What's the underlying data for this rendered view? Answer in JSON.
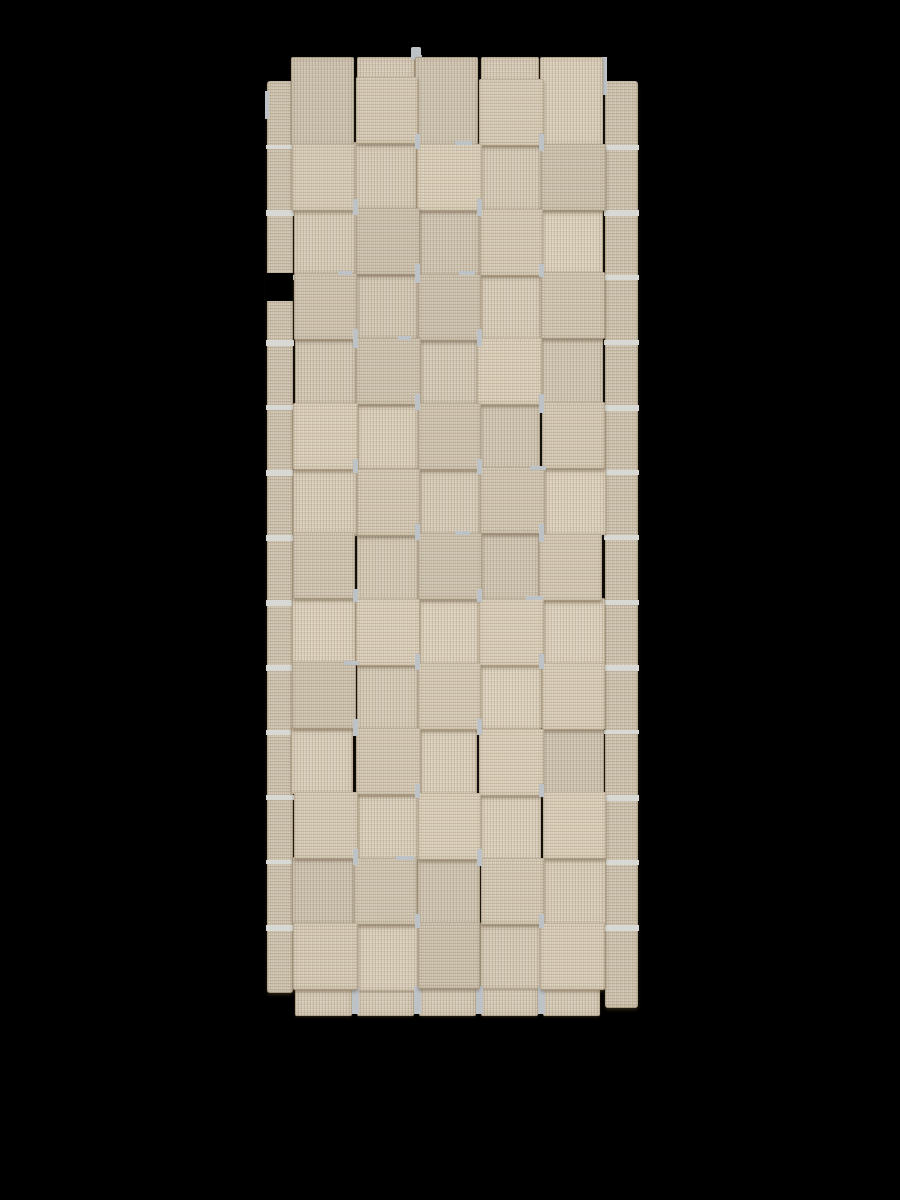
{
  "image": {
    "type": "product-photo",
    "subject": "beige basket-weave rug runner, top view",
    "background_color": "#000000"
  },
  "rug": {
    "x": 265,
    "y": 47,
    "width": 375,
    "height": 975,
    "grid": {
      "columns": 5,
      "rows": 14,
      "cell_width": 62,
      "cell_height": 65,
      "origin_x": 28,
      "origin_y": 31,
      "top_stub_y": 10,
      "bottom_tab_height": 28
    },
    "tails": {
      "left_x": 2,
      "left_width": 26,
      "right_x": 340,
      "right_width": 33,
      "top": 34,
      "left_bottom": 946,
      "right_bottom": 961,
      "left_notch": {
        "x": 0,
        "y": 226,
        "w": 28,
        "h": 28
      }
    },
    "colors": {
      "base": "#cfc3ad",
      "base_tail": "#c9bda8",
      "stitch_dark": "rgba(118,96,64,0.16)",
      "stitch_light": "rgba(255,255,255,0.14)",
      "fleck": "rgba(255,255,255,0.20)",
      "shadow": "rgba(88,72,48,0.45)",
      "edge": "rgba(125,103,72,0.28)",
      "gap": "#bdc2c7",
      "gap_light": "#d8d9d5"
    },
    "top_gray_tab": {
      "x": 146,
      "y": 0,
      "w": 10,
      "h": 13
    },
    "top_notches": [
      {
        "x": 150,
        "y": 8,
        "w": 7,
        "h": 28
      },
      {
        "x": 336,
        "y": 10,
        "w": 6,
        "h": 38
      },
      {
        "x": 0,
        "y": 44,
        "w": 4,
        "h": 28
      }
    ]
  }
}
